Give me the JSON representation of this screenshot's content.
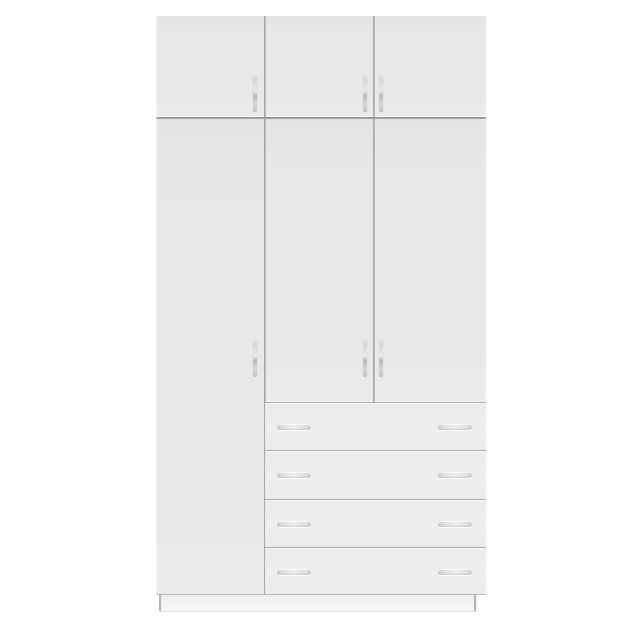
{
  "meta": {
    "description": "White three-door wardrobe with three overhead cabinet doors and four drawers, photographed front-on against a white background"
  },
  "colors": {
    "background": "#ffffff",
    "panel": "#e8e8e9",
    "panel_dark": "#e4e4e5",
    "panel_light": "#ebebec",
    "drawer_face": "#ebebec",
    "gap_line": "#9d9d9f",
    "divider_dark": "#8f8f91",
    "drawer_line": "#ababad",
    "plinth": "#f3f3f4",
    "foot_line": "#b3b3b5",
    "handle_metal_dark": "#b7b7ba",
    "handle_metal_mid": "#d6d6d8",
    "handle_metal_light": "#ededee"
  },
  "structure": {
    "top_cabinet": {
      "door_count": 3,
      "handle_style": "vertical-bar",
      "handle_positions": [
        "right-edge-of-door-1",
        "right-edge-of-door-2",
        "left-edge-of-door-3"
      ]
    },
    "main_section": {
      "door_count": 3,
      "left_door_full_height": true,
      "handle_style": "vertical-bar"
    },
    "drawer_section": {
      "drawer_count": 4,
      "handles_per_drawer": 2,
      "handle_style": "horizontal-bar"
    },
    "base": {
      "plinth": true,
      "feet_visible": 2
    }
  }
}
